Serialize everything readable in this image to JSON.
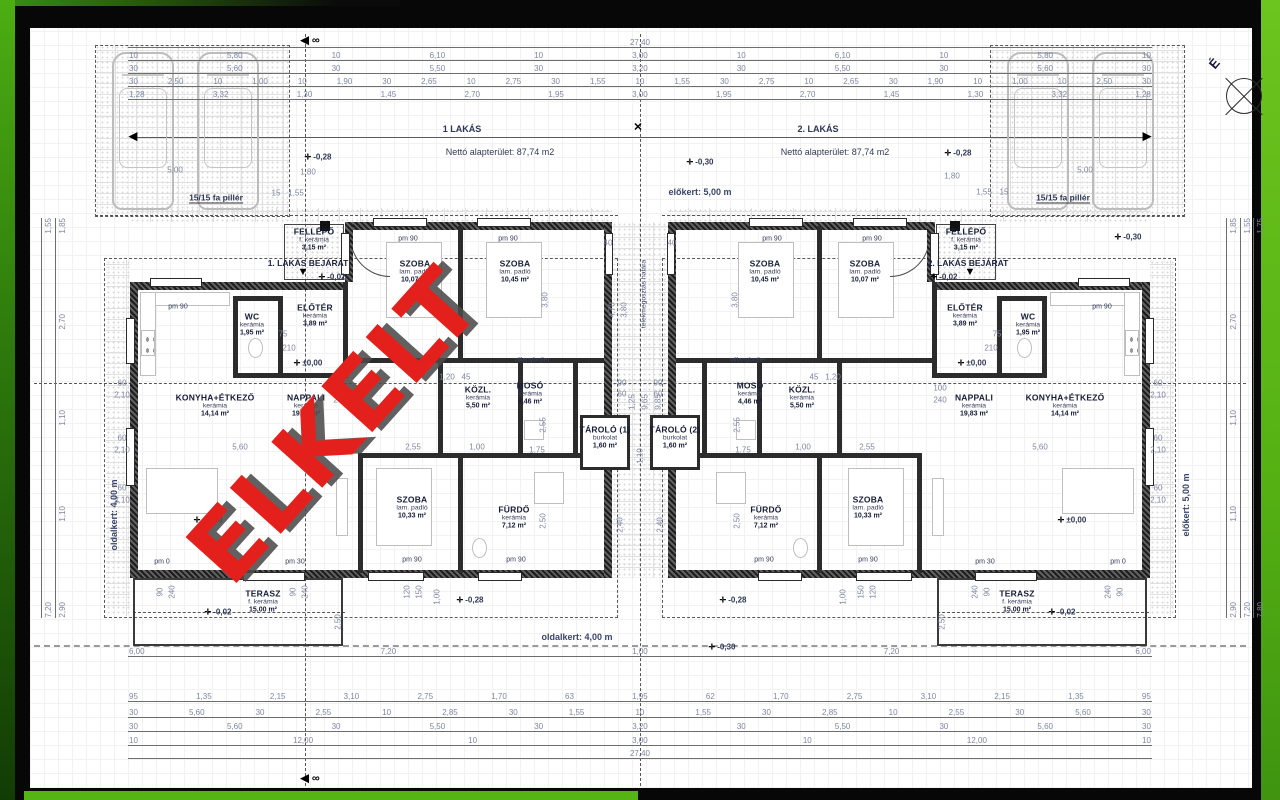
{
  "frame": {
    "left_green_top": "#4cae13",
    "right_green": "#5fb818",
    "bottom_green": "#54b413",
    "paper": "#ffffff"
  },
  "watermark": {
    "text": "ELKELT",
    "color": "#e4201c",
    "shadow": "#4b4b4b"
  },
  "compass": {
    "label": "É"
  },
  "plan": {
    "units": [
      {
        "header": "1 LAKÁS",
        "hx": 462,
        "hy": 129,
        "net_area": "Nettó alapterület: 87,74 m2",
        "nx": 500,
        "ny": 152,
        "entrance": "1. LAKÁS BEJÁRAT",
        "ex": 308,
        "ey": 263
      },
      {
        "header": "2. LAKÁS",
        "hx": 818,
        "hy": 129,
        "net_area": "Nettó alapterület: 87,74 m2",
        "nx": 835,
        "ny": 152,
        "entrance": "2. LAKÁS BEJÁRAT",
        "ex": 968,
        "ey": 263
      }
    ],
    "rooms": [
      {
        "u": 1,
        "name": "SZOBA",
        "floor": "lam. padló",
        "area": "10,07 m²",
        "x": 415,
        "y": 272
      },
      {
        "u": 1,
        "name": "SZOBA",
        "floor": "lam. padló",
        "area": "10,45 m²",
        "x": 515,
        "y": 272
      },
      {
        "u": 1,
        "name": "WC",
        "floor": "kerámia",
        "area": "1,95 m²",
        "x": 252,
        "y": 325
      },
      {
        "u": 1,
        "name": "ELŐTÉR",
        "floor": "kerámia",
        "area": "3,89 m²",
        "x": 315,
        "y": 316
      },
      {
        "u": 1,
        "name": "FELLÉPŐ",
        "floor": "f. kerámia",
        "area": "3,15 m²",
        "x": 314,
        "y": 240
      },
      {
        "u": 1,
        "name": "KONYHA+ÉTKEZŐ",
        "floor": "kerámia",
        "area": "14,14 m²",
        "x": 215,
        "y": 406
      },
      {
        "u": 1,
        "name": "NAPPALI",
        "floor": "kerámia",
        "area": "19,83 m²",
        "x": 306,
        "y": 406
      },
      {
        "u": 1,
        "name": "KÖZL.",
        "floor": "kerámia",
        "area": "5,50 m²",
        "x": 478,
        "y": 398
      },
      {
        "u": 1,
        "name": "MOSÓ",
        "floor": "kerámia",
        "area": "4,46 m²",
        "x": 530,
        "y": 394
      },
      {
        "u": 1,
        "name": "FÜRDŐ",
        "floor": "kerámia",
        "area": "7,12 m²",
        "x": 514,
        "y": 518
      },
      {
        "u": 1,
        "name": "SZOBA",
        "floor": "lam. padló",
        "area": "10,33 m²",
        "x": 412,
        "y": 508
      },
      {
        "u": 1,
        "name": "TERASZ",
        "floor": "f. kerámia",
        "area": "15,00 m²",
        "x": 263,
        "y": 602
      },
      {
        "u": 0,
        "name": "TÁROLÓ (1)",
        "floor": "burkolat",
        "area": "1,60 m²",
        "x": 605,
        "y": 438
      },
      {
        "u": 0,
        "name": "TÁROLÓ (2)",
        "floor": "burkolat",
        "area": "1,60 m²",
        "x": 675,
        "y": 438
      },
      {
        "u": 2,
        "name": "SZOBA",
        "floor": "lam. padló",
        "area": "10,45 m²",
        "x": 765,
        "y": 272
      },
      {
        "u": 2,
        "name": "SZOBA",
        "floor": "lam. padló",
        "area": "10,07 m²",
        "x": 865,
        "y": 272
      },
      {
        "u": 2,
        "name": "WC",
        "floor": "kerámia",
        "area": "1,95 m²",
        "x": 1028,
        "y": 325
      },
      {
        "u": 2,
        "name": "ELŐTÉR",
        "floor": "kerámia",
        "area": "3,89 m²",
        "x": 965,
        "y": 316
      },
      {
        "u": 2,
        "name": "FELLÉPŐ",
        "floor": "f. kerámia",
        "area": "3,15 m²",
        "x": 966,
        "y": 240
      },
      {
        "u": 2,
        "name": "NAPPALI",
        "floor": "kerámia",
        "area": "19,83 m²",
        "x": 974,
        "y": 406
      },
      {
        "u": 2,
        "name": "KONYHA+ÉTKEZŐ",
        "floor": "kerámia",
        "area": "14,14 m²",
        "x": 1065,
        "y": 406
      },
      {
        "u": 2,
        "name": "KÖZL.",
        "floor": "kerámia",
        "area": "5,50 m²",
        "x": 802,
        "y": 398
      },
      {
        "u": 2,
        "name": "MOSÓ",
        "floor": "kerámia",
        "area": "4,46 m²",
        "x": 750,
        "y": 394
      },
      {
        "u": 2,
        "name": "FÜRDŐ",
        "floor": "kerámia",
        "area": "7,12 m²",
        "x": 766,
        "y": 518
      },
      {
        "u": 2,
        "name": "SZOBA",
        "floor": "lam. padló",
        "area": "10,33 m²",
        "x": 868,
        "y": 508
      },
      {
        "u": 2,
        "name": "TERASZ",
        "floor": "f. kerámia",
        "area": "15,00 m²",
        "x": 1017,
        "y": 602
      }
    ],
    "dim_rows": [
      {
        "y": 46,
        "x1": 128,
        "x2": 1152,
        "v": [
          "27,40"
        ]
      },
      {
        "y": 59,
        "x1": 128,
        "x2": 1152,
        "v": [
          "10",
          "5,80",
          "10",
          "6,10",
          "10",
          "3,00",
          "10",
          "6,10",
          "10",
          "5,80",
          "10"
        ]
      },
      {
        "y": 72,
        "x1": 128,
        "x2": 1152,
        "v": [
          "30",
          "5,60",
          "30",
          "5,50",
          "30",
          "3,20",
          "30",
          "5,50",
          "30",
          "5,60",
          "30"
        ]
      },
      {
        "y": 85,
        "x1": 128,
        "x2": 1152,
        "v": [
          "30",
          "2,50",
          "10",
          "1,00",
          "10",
          "1,90",
          "30",
          "2,65",
          "10",
          "2,75",
          "30",
          "1,55",
          "10",
          "1,55",
          "30",
          "2,75",
          "10",
          "2,65",
          "30",
          "1,90",
          "10",
          "1,00",
          "10",
          "2,50",
          "30"
        ]
      },
      {
        "y": 98,
        "x1": 128,
        "x2": 1152,
        "v": [
          "1,28",
          "3,32",
          "1,30",
          "1,45",
          "2,70",
          "1,95",
          "3,00",
          "1,95",
          "2,70",
          "1,45",
          "1,30",
          "3,32",
          "1,28"
        ]
      },
      {
        "y": 655,
        "x1": 128,
        "x2": 1152,
        "v": [
          "6,00",
          "7,20",
          "1,00",
          "7,20",
          "6,00"
        ]
      },
      {
        "y": 700,
        "x1": 128,
        "x2": 1152,
        "v": [
          "95",
          "1,35",
          "2,15",
          "3,10",
          "2,75",
          "1,70",
          "63",
          "1,95",
          "62",
          "1,70",
          "2,75",
          "3,10",
          "2,15",
          "1,35",
          "95"
        ]
      },
      {
        "y": 716,
        "x1": 128,
        "x2": 1152,
        "v": [
          "30",
          "5,60",
          "30",
          "2,55",
          "10",
          "2,85",
          "30",
          "1,55",
          "10",
          "1,55",
          "30",
          "2,85",
          "10",
          "2,55",
          "30",
          "5,60",
          "30"
        ]
      },
      {
        "y": 730,
        "x1": 128,
        "x2": 1152,
        "v": [
          "30",
          "5,60",
          "30",
          "5,50",
          "30",
          "3,20",
          "30",
          "5,50",
          "30",
          "5,60",
          "30"
        ]
      },
      {
        "y": 744,
        "x1": 128,
        "x2": 1152,
        "v": [
          "10",
          "12,00",
          "10",
          "3,00",
          "10",
          "12,00",
          "10"
        ]
      },
      {
        "y": 757,
        "x1": 128,
        "x2": 1152,
        "v": [
          "27,40"
        ]
      }
    ],
    "dim_cols": [
      {
        "x": 55,
        "y1": 218,
        "y2": 618,
        "v": [
          "1,85",
          "2,70",
          "1,10",
          "1,10",
          "2,90"
        ]
      },
      {
        "x": 41,
        "y1": 218,
        "y2": 618,
        "v": [
          "1,55",
          "7,20"
        ]
      },
      {
        "x": 1226,
        "y1": 218,
        "y2": 618,
        "v": [
          "1,85",
          "2,70",
          "1,10",
          "1,10",
          "2,90"
        ]
      },
      {
        "x": 1240,
        "y1": 218,
        "y2": 618,
        "v": [
          "1,55",
          "7,20"
        ]
      },
      {
        "x": 1253,
        "y1": 218,
        "y2": 618,
        "v": [
          "1,75",
          "7,80"
        ]
      }
    ],
    "dim_labels": [
      [
        "5,00",
        175,
        170,
        0
      ],
      [
        "5,00",
        1085,
        170,
        0
      ],
      [
        "1,80",
        308,
        172,
        0
      ],
      [
        "1,80",
        952,
        176,
        0
      ],
      [
        "15",
        276,
        193,
        0
      ],
      [
        "1,55",
        296,
        193,
        0
      ],
      [
        "1,55",
        984,
        192,
        0
      ],
      [
        "15",
        1004,
        192,
        0
      ],
      [
        "40",
        608,
        243,
        0
      ],
      [
        "40",
        672,
        243,
        0
      ],
      [
        "4,70",
        612,
        310,
        1
      ],
      [
        "3,80",
        624,
        310,
        1
      ],
      [
        "3,80",
        545,
        300,
        1
      ],
      [
        "3,80",
        735,
        300,
        1
      ],
      [
        "90",
        622,
        383,
        0
      ],
      [
        "60",
        622,
        394,
        0
      ],
      [
        "90",
        658,
        383,
        0
      ],
      [
        "60",
        658,
        394,
        0
      ],
      [
        "1,25",
        632,
        402,
        1
      ],
      [
        "9,65",
        645,
        402,
        1
      ],
      [
        "9,85",
        658,
        402,
        1
      ],
      [
        "2,40",
        620,
        525,
        1
      ],
      [
        "2,40",
        660,
        525,
        1
      ],
      [
        "1,10",
        640,
        456,
        1
      ],
      [
        "5,60",
        240,
        447,
        0
      ],
      [
        "5,60",
        1040,
        447,
        0
      ],
      [
        "2,55",
        413,
        447,
        0
      ],
      [
        "2,55",
        867,
        447,
        0
      ],
      [
        "1,00",
        477,
        447,
        0
      ],
      [
        "1,00",
        803,
        447,
        0
      ],
      [
        "1,75",
        537,
        450,
        0
      ],
      [
        "1,75",
        743,
        450,
        0
      ],
      [
        "75",
        283,
        334,
        0
      ],
      [
        "210",
        289,
        348,
        0
      ],
      [
        "75",
        997,
        334,
        0
      ],
      [
        "210",
        991,
        348,
        0
      ],
      [
        "100",
        340,
        388,
        0
      ],
      [
        "240",
        340,
        400,
        0
      ],
      [
        "100",
        940,
        388,
        0
      ],
      [
        "240",
        940,
        400,
        0
      ],
      [
        "1,20",
        447,
        377,
        0
      ],
      [
        "45",
        466,
        377,
        0
      ],
      [
        "45",
        814,
        377,
        0
      ],
      [
        "1,20",
        833,
        377,
        0
      ],
      [
        "2,55",
        543,
        425,
        1
      ],
      [
        "2,50",
        543,
        521,
        1
      ],
      [
        "2,55",
        737,
        425,
        1
      ],
      [
        "2,50",
        737,
        521,
        1
      ],
      [
        "2,50",
        338,
        622,
        1
      ],
      [
        "2,50",
        942,
        622,
        1
      ],
      [
        "60",
        122,
        383,
        0
      ],
      [
        "2,10",
        122,
        395,
        0
      ],
      [
        "60",
        122,
        438,
        0
      ],
      [
        "2,10",
        122,
        450,
        0
      ],
      [
        "60",
        122,
        488,
        0
      ],
      [
        "2,10",
        122,
        500,
        0
      ],
      [
        "60",
        1158,
        383,
        0
      ],
      [
        "2,10",
        1158,
        395,
        0
      ],
      [
        "60",
        1158,
        438,
        0
      ],
      [
        "2,10",
        1158,
        450,
        0
      ],
      [
        "60",
        1158,
        488,
        0
      ],
      [
        "2,10",
        1158,
        500,
        0
      ],
      [
        "90",
        160,
        592,
        1
      ],
      [
        "240",
        172,
        592,
        1
      ],
      [
        "90",
        293,
        592,
        1
      ],
      [
        "240",
        305,
        592,
        1
      ],
      [
        "90",
        1120,
        592,
        1
      ],
      [
        "240",
        1108,
        592,
        1
      ],
      [
        "90",
        987,
        592,
        1
      ],
      [
        "240",
        975,
        592,
        1
      ],
      [
        "120",
        407,
        592,
        1
      ],
      [
        "150",
        419,
        592,
        1
      ],
      [
        "1,00",
        437,
        597,
        1
      ],
      [
        "120",
        873,
        592,
        1
      ],
      [
        "150",
        861,
        592,
        1
      ],
      [
        "1,00",
        843,
        597,
        1
      ]
    ],
    "levels": [
      [
        "-0,28",
        318,
        157
      ],
      [
        "-0,30",
        700,
        162
      ],
      [
        "-0,28",
        958,
        153
      ],
      [
        "-0,30",
        1128,
        237
      ],
      [
        "-0,02",
        332,
        277
      ],
      [
        "-0,02",
        944,
        277
      ],
      [
        "±0,00",
        308,
        363
      ],
      [
        "±0,00",
        972,
        363
      ],
      [
        "±0,00",
        208,
        520
      ],
      [
        "±0,00",
        1072,
        520
      ],
      [
        "-0,02",
        218,
        612
      ],
      [
        "-0,02",
        1062,
        612
      ],
      [
        "-0,28",
        470,
        600
      ],
      [
        "-0,28",
        733,
        600
      ],
      [
        "-0,30",
        722,
        647
      ]
    ],
    "pm_labels": [
      [
        "pm 90",
        408,
        239
      ],
      [
        "pm 90",
        508,
        239
      ],
      [
        "pm 90",
        772,
        239
      ],
      [
        "pm 90",
        872,
        239
      ],
      [
        "pm 90",
        178,
        307
      ],
      [
        "pm 90",
        1102,
        307
      ],
      [
        "pm 90",
        412,
        560
      ],
      [
        "pm 90",
        516,
        560
      ],
      [
        "pm 90",
        764,
        560
      ],
      [
        "pm 90",
        868,
        560
      ],
      [
        "pm 30",
        295,
        562
      ],
      [
        "pm 30",
        985,
        562
      ],
      [
        "pm 0",
        162,
        562
      ],
      [
        "pm 0",
        1118,
        562
      ]
    ],
    "site_labels": [
      {
        "t": "előkert: 5,00 m",
        "x": 700,
        "y": 192,
        "c": "site",
        "r": 0
      },
      {
        "t": "előkert: 5,00 m",
        "x": 1186,
        "y": 505,
        "c": "site",
        "r": 1
      },
      {
        "t": "oldalkert: 4,00 m",
        "x": 577,
        "y": 637,
        "c": "site",
        "r": 0
      },
      {
        "t": "oldalkert: 4,00 m",
        "x": 114,
        "y": 515,
        "c": "site",
        "r": 1
      },
      {
        "t": "telekmegosztás határa",
        "x": 644,
        "y": 294,
        "c": "tiny",
        "r": 1
      },
      {
        "t": "15/15 fa pillér",
        "x": 216,
        "y": 198,
        "c": "pillar",
        "r": 0
      },
      {
        "t": "15/15 fa pillér",
        "x": 1063,
        "y": 198,
        "c": "pillar",
        "r": 0
      },
      {
        "t": "villanybojler",
        "x": 532,
        "y": 360,
        "c": "tiny",
        "r": 0
      },
      {
        "t": "villanybojler",
        "x": 748,
        "y": 360,
        "c": "tiny",
        "r": 0
      },
      {
        "t": "◀ ∞",
        "x": 310,
        "y": 40,
        "c": "sec",
        "r": 0
      },
      {
        "t": "◀ ∞",
        "x": 310,
        "y": 778,
        "c": "sec",
        "r": 0
      },
      {
        "t": "✕",
        "x": 638,
        "y": 127,
        "c": "sec",
        "r": 0
      },
      {
        "t": "◀",
        "x": 133,
        "y": 136,
        "c": "sec",
        "r": 0
      },
      {
        "t": "▶",
        "x": 1147,
        "y": 136,
        "c": "sec",
        "r": 0
      },
      {
        "t": "▼",
        "x": 303,
        "y": 272,
        "c": "sec",
        "r": 0
      },
      {
        "t": "▼",
        "x": 970,
        "y": 272,
        "c": "sec",
        "r": 0
      }
    ],
    "level_marker_glyph": "✛"
  }
}
